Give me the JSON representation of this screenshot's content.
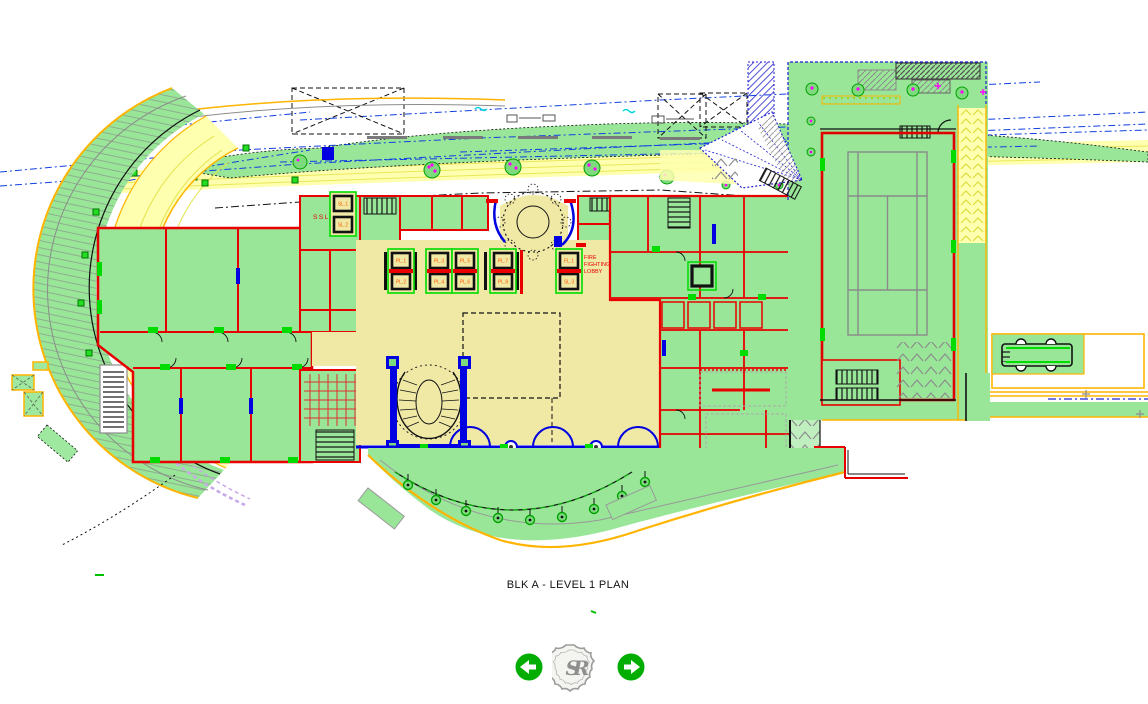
{
  "plan": {
    "caption": "BLK A - LEVEL 1 PLAN",
    "labels": {
      "ssl": "SSL",
      "sl1": "SL.1",
      "sl2": "SL.2",
      "fl1": "FL.1",
      "sl3": "SL.3",
      "pl1": "PL.1",
      "pl2": "PL.2",
      "pl3": "PL.3",
      "pl4": "PL.4",
      "pl5": "PL.5",
      "pl6": "PL.6",
      "pl7": "PL.7",
      "pl8": "PL.8",
      "fire_lobby": [
        "FIRE",
        "FIGHTING",
        "LOBBY"
      ]
    },
    "colors": {
      "landscape_green": "#99e699",
      "lobby_beige": "#f0e9a6",
      "wall_red": "#e80000",
      "accent_orange": "#ffb400",
      "road_yellow": "#ffffb0",
      "glazing_blue": "#0000e0",
      "bright_green": "#00dc00",
      "hatch_gray": "#8c8c8c",
      "tree_magenta": "#ff00ff"
    }
  },
  "nav": {
    "logo_monogram": "SR"
  }
}
